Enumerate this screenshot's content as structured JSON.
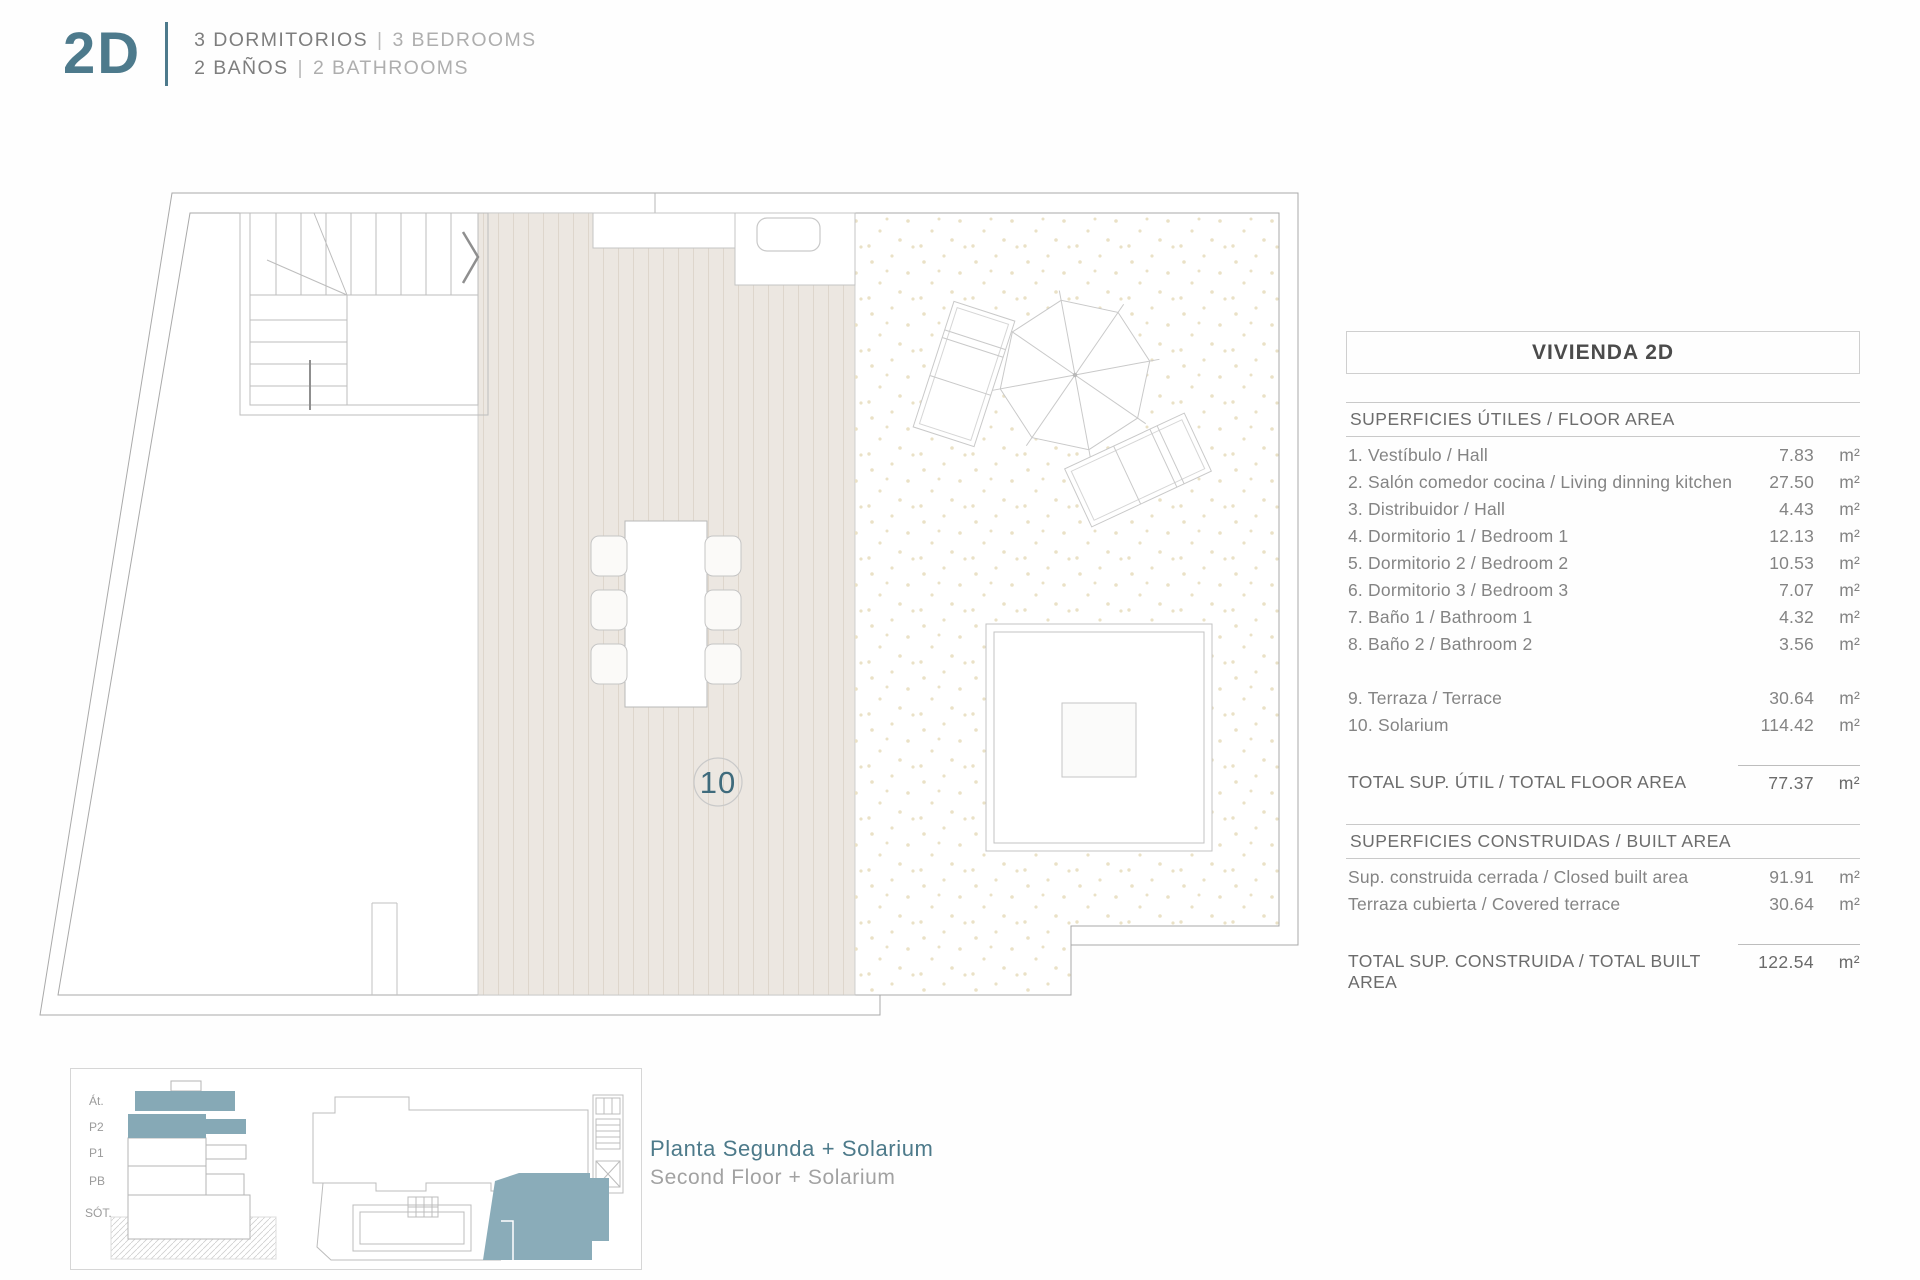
{
  "accent": "#4d7a8c",
  "header": {
    "unit_code": "2D",
    "sep": "|",
    "bedrooms_es": "3 DORMITORIOS",
    "bedrooms_en": "3 BEDROOMS",
    "bathrooms_es": "2 BAÑOS",
    "bathrooms_en": "2 BATHROOMS"
  },
  "plan": {
    "solarium_label": "10"
  },
  "keyplan": {
    "floors": [
      "Át.",
      "P2",
      "P1",
      "PB",
      "SÓT."
    ]
  },
  "caption": {
    "es": "Planta Segunda + Solarium",
    "en": "Second Floor + Solarium"
  },
  "table": {
    "title": "VIVIENDA 2D",
    "floor_section": "SUPERFICIES ÚTILES / FLOOR AREA",
    "floor_rows": [
      {
        "label": "1. Vestíbulo / Hall",
        "value": "7.83",
        "unit": "m²"
      },
      {
        "label": "2. Salón comedor cocina / Living dinning kitchen",
        "value": "27.50",
        "unit": "m²"
      },
      {
        "label": "3. Distribuidor / Hall",
        "value": "4.43",
        "unit": "m²"
      },
      {
        "label": "4. Dormitorio 1 / Bedroom 1",
        "value": "12.13",
        "unit": "m²"
      },
      {
        "label": "5. Dormitorio 2 / Bedroom 2",
        "value": "10.53",
        "unit": "m²"
      },
      {
        "label": "6. Dormitorio 3 / Bedroom 3",
        "value": "7.07",
        "unit": "m²"
      },
      {
        "label": "7. Baño 1 / Bathroom 1",
        "value": "4.32",
        "unit": "m²"
      },
      {
        "label": "8. Baño 2 / Bathroom 2",
        "value": "3.56",
        "unit": "m²"
      }
    ],
    "outdoor_rows": [
      {
        "label": "9. Terraza / Terrace",
        "value": "30.64",
        "unit": "m²"
      },
      {
        "label": "10. Solarium",
        "value": "114.42",
        "unit": "m²"
      }
    ],
    "total_floor": {
      "label": "TOTAL SUP. ÚTIL / TOTAL FLOOR AREA",
      "value": "77.37",
      "unit": "m²"
    },
    "built_section": "SUPERFICIES CONSTRUIDAS / BUILT AREA",
    "built_rows": [
      {
        "label": "Sup. construida cerrada / Closed built area",
        "value": "91.91",
        "unit": "m²"
      },
      {
        "label": "Terraza cubierta / Covered terrace",
        "value": "30.64",
        "unit": "m²"
      }
    ],
    "total_built": {
      "label": "TOTAL SUP. CONSTRUIDA /  TOTAL BUILT AREA",
      "value": "122.54",
      "unit": "m²"
    }
  }
}
